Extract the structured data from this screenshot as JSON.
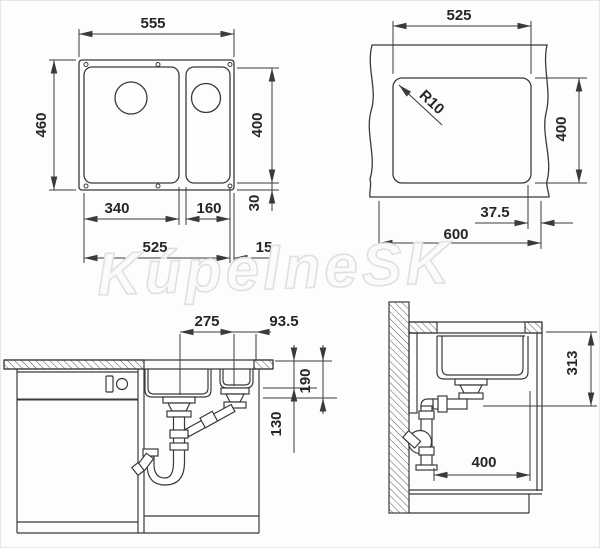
{
  "top_view": {
    "overall_width": "555",
    "overall_depth": "460",
    "inner_depth": "400",
    "main_bowl_width": "340",
    "small_bowl_width": "160",
    "rear_margin": "30",
    "mount_span": "525",
    "edge_gap": "15"
  },
  "cutout_view": {
    "cutout_width": "525",
    "corner_radius": "R10",
    "cutout_depth": "400",
    "edge_clearance": "37.5",
    "cabinet_width": "600"
  },
  "front_view": {
    "drain_spacing": "275",
    "drain_to_edge": "93.5",
    "main_bowl_depth": "190",
    "small_bowl_depth": "130"
  },
  "side_view": {
    "install_depth": "313",
    "min_depth": "400"
  },
  "watermark": {
    "text": "KúpelneSK"
  },
  "colors": {
    "line": "#3a3a3a",
    "text": "#262626",
    "watermark": "#e0e0e0"
  }
}
